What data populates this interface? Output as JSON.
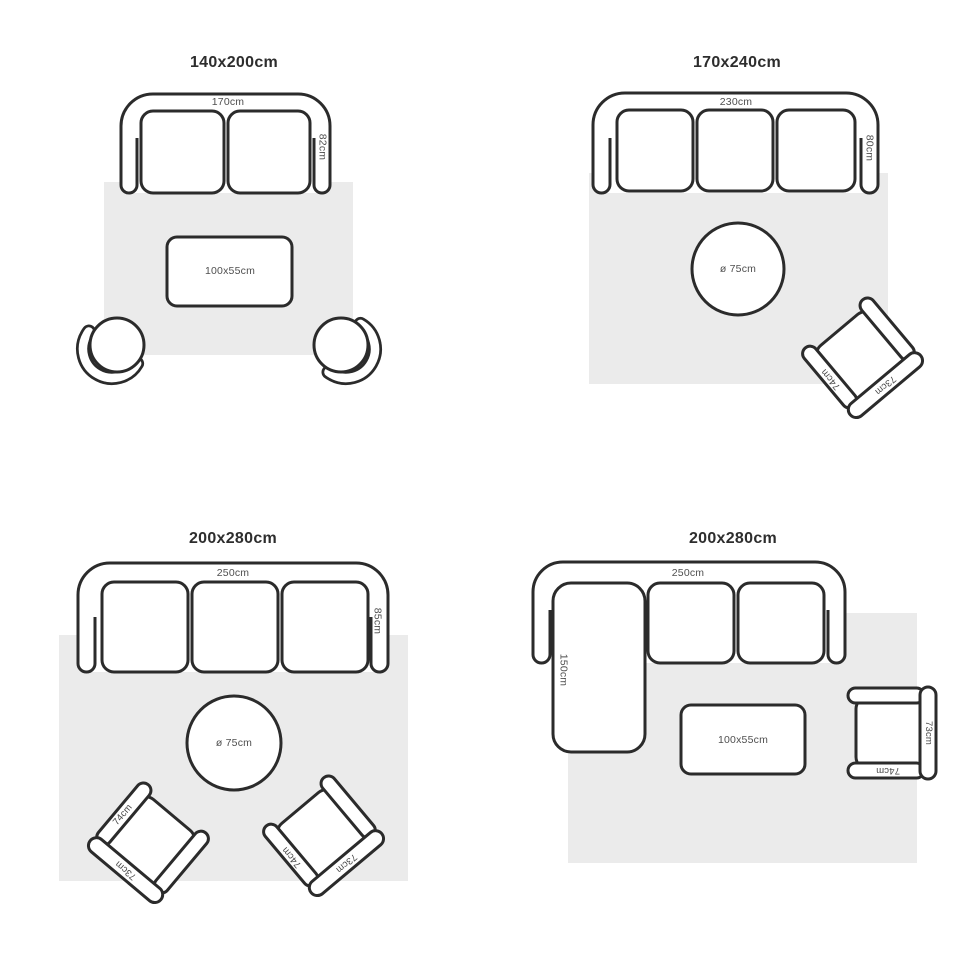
{
  "diagram": {
    "description_colors": {
      "outline": "#2b2b2b",
      "rug": "#ebebeb",
      "label_text": "#4f4f4f",
      "title_text": "#2d2d2d",
      "furniture_fill": "#ffffff"
    }
  },
  "quadrants": [
    {
      "title": "140x200cm",
      "sofa": {
        "type": "2-seat sofa",
        "width_label": "170cm",
        "depth_label": "82cm"
      },
      "coffee_table": {
        "size_label": "100x55cm"
      },
      "swivel_chairs": 2
    },
    {
      "title": "170x240cm",
      "sofa": {
        "type": "3-seat sofa",
        "width_label": "230cm",
        "depth_label": "80cm"
      },
      "round_table": {
        "size_label": "ø 75cm"
      },
      "armchairs": [
        {
          "arm_label": "74cm",
          "back_label": "73cm"
        }
      ]
    },
    {
      "title": "200x280cm",
      "sofa": {
        "type": "3-seat sofa",
        "width_label": "250cm",
        "depth_label": "85cm"
      },
      "round_table": {
        "size_label": "ø 75cm"
      },
      "armchairs": [
        {
          "arm_label": "74cm",
          "back_label": "73cm"
        },
        {
          "arm_label": "74cm",
          "back_label": "73cm"
        }
      ]
    },
    {
      "title": "200x280cm",
      "sofa": {
        "type": "L-shaped sectional sofa",
        "width_label": "250cm",
        "chaise_label": "150cm"
      },
      "coffee_table": {
        "size_label": "100x55cm"
      },
      "armchairs": [
        {
          "arm_label": "74cm",
          "back_label": "73cm"
        }
      ]
    }
  ]
}
